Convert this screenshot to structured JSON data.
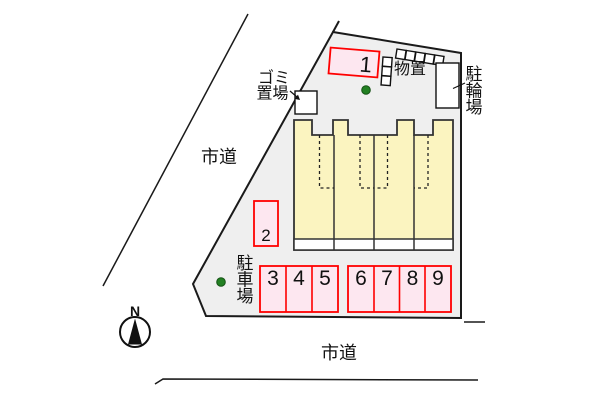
{
  "roads": {
    "left_label": "市道",
    "bottom_label": "市道"
  },
  "site": {
    "garbage_label_line1": "ゴミ",
    "garbage_label_line2": "置場",
    "shed_label": "物置",
    "bicycle_label_chars": [
      "駐",
      "輪",
      "場"
    ],
    "parking_area_label_chars": [
      "駐",
      "車",
      "場"
    ],
    "parking_spaces": [
      "1",
      "2",
      "3",
      "4",
      "5",
      "6",
      "7",
      "8",
      "9"
    ]
  },
  "compass": {
    "north_label": "N"
  },
  "colors": {
    "site_fill": "#efefef",
    "building_fill": "#fbf4c0",
    "parking_fill": "#fde7f0",
    "parking_border": "#ff0000",
    "tree_green": "#228022",
    "line_black": "#1a1a1a"
  }
}
